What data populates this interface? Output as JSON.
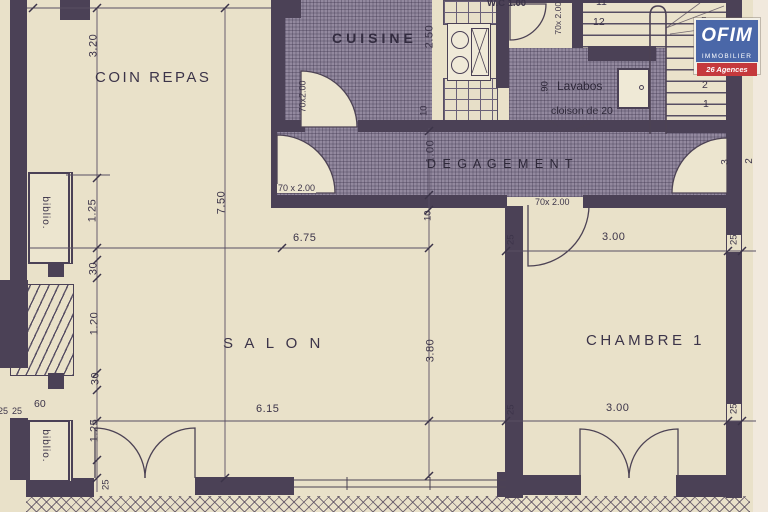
{
  "rooms": {
    "coin_repas": "COIN REPAS",
    "cuisine": "CUISINE",
    "wc": "W.C 1.00",
    "lavabos": "Lavabos",
    "degagement": "D E G A G E M E N T",
    "salon": "S A L O N",
    "chambre1": "CHAMBRE 1"
  },
  "annotations": {
    "cloison": "cloison de 20",
    "biblio_top": "biblio.",
    "biblio_bottom": "biblio.",
    "shelf_width": "60"
  },
  "doors": {
    "coin_repas": "70 x 2.00",
    "cuisine": "70x2.00",
    "wc": "70x 2.00",
    "chambre1": "70x 2.00"
  },
  "dims": {
    "coin_h": "3.20",
    "chain": [
      "1.25",
      "30",
      "1.20",
      "30",
      "1.25"
    ],
    "wall_bl": "25",
    "margin_left": [
      "25",
      "25"
    ],
    "total_h": "7.50",
    "top_w": "6.75",
    "bottom_w": "6.15",
    "cuisine_d": "2.50",
    "cuisine_wall": "10",
    "deg_w": "1.00",
    "deg_wall": "10",
    "salon_h": "3.80",
    "lav_door": ".90",
    "ch_top": "3.00",
    "ch_bottom": "3.00",
    "ch_t_l": "25",
    "ch_t_r": "25",
    "ch_b_l": "25",
    "ch_b_r": "25",
    "margin_r_a": "3",
    "margin_r_b": "2"
  },
  "stairs": {
    "numbers": [
      "11",
      "12",
      "5",
      "3",
      "2",
      "1"
    ]
  },
  "logo": {
    "name": "OFIM",
    "line2": "IMMOBILIER",
    "line3": "26 Agences",
    "blue": "#4a67a8",
    "red": "#c5393c"
  },
  "colors": {
    "paper": "#e9e1c9",
    "wall": "#4b4156",
    "hatch": "#93899f",
    "ink": "#3c3449"
  }
}
